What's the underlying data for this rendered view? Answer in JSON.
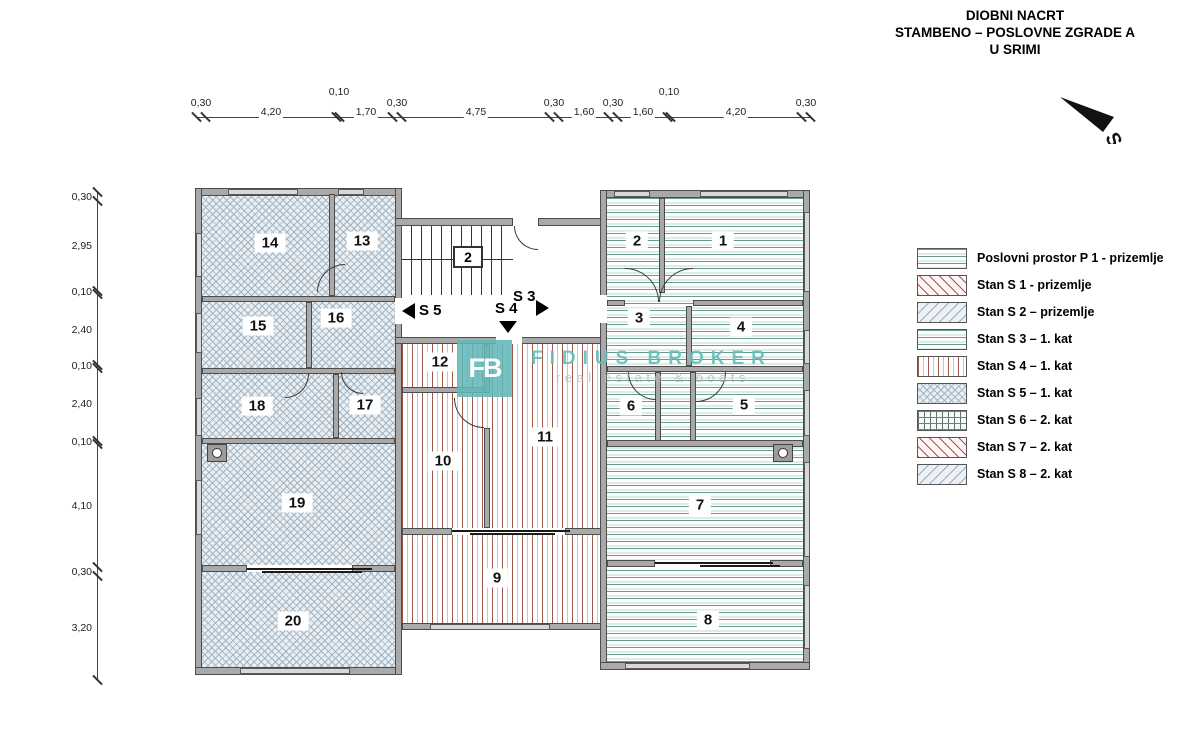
{
  "title": {
    "line1": "DIOBNI NACRT",
    "line2": "STAMBENO – POSLOVNE ZGRADE A",
    "line3": "U SRIMI"
  },
  "north": {
    "label": "S"
  },
  "legend": {
    "items": [
      {
        "label": "Poslovni prostor P 1 - prizemlje",
        "pattern": "green-h"
      },
      {
        "label": "Stan S 1 - prizemlje",
        "pattern": "red-diag"
      },
      {
        "label": "Stan S 2 – prizemlje",
        "pattern": "blue-diag"
      },
      {
        "label": "Stan S 3 – 1. kat",
        "pattern": "green-h"
      },
      {
        "label": "Stan S 4 – 1. kat",
        "pattern": "red-v"
      },
      {
        "label": "Stan S 5 – 1. kat",
        "pattern": "blue-x"
      },
      {
        "label": "Stan S 6 – 2. kat",
        "pattern": "green-grid"
      },
      {
        "label": "Stan S 7 – 2. kat",
        "pattern": "red-diag"
      },
      {
        "label": "Stan S 8 – 2. kat",
        "pattern": "blue-diag"
      }
    ]
  },
  "dimensions": {
    "top": [
      "0,30",
      "4,20",
      "0,10",
      "1,70",
      "0,30",
      "4,75",
      "0,30",
      "1,60",
      "0,30",
      "1,60",
      "0,10",
      "4,20",
      "0,30"
    ],
    "left": [
      "0,30",
      "2,95",
      "0,10",
      "2,40",
      "0,10",
      "2,40",
      "0,10",
      "4,10",
      "0,30",
      "3,20"
    ]
  },
  "plan": {
    "stair_label": "2",
    "unit_markers": [
      {
        "label": "S 5",
        "direction": "left"
      },
      {
        "label": "S 4",
        "direction": "down"
      },
      {
        "label": "S 3",
        "direction": "right"
      }
    ],
    "room_labels": [
      "1",
      "2",
      "3",
      "4",
      "5",
      "6",
      "7",
      "8",
      "9",
      "10",
      "11",
      "12",
      "13",
      "14",
      "15",
      "16",
      "17",
      "18",
      "19",
      "20"
    ]
  },
  "watermark": {
    "logo": "FB",
    "name": "FIDIUS BROKER",
    "tagline": "real estate & boats"
  },
  "colors": {
    "hatch_green": "#679e89",
    "hatch_red": "#9e594b",
    "hatch_blue": "#a3b4c2",
    "wall": "#a9a9a9",
    "wall_outline": "#4d4d4d",
    "watermark_teal": "#62b8b8"
  }
}
